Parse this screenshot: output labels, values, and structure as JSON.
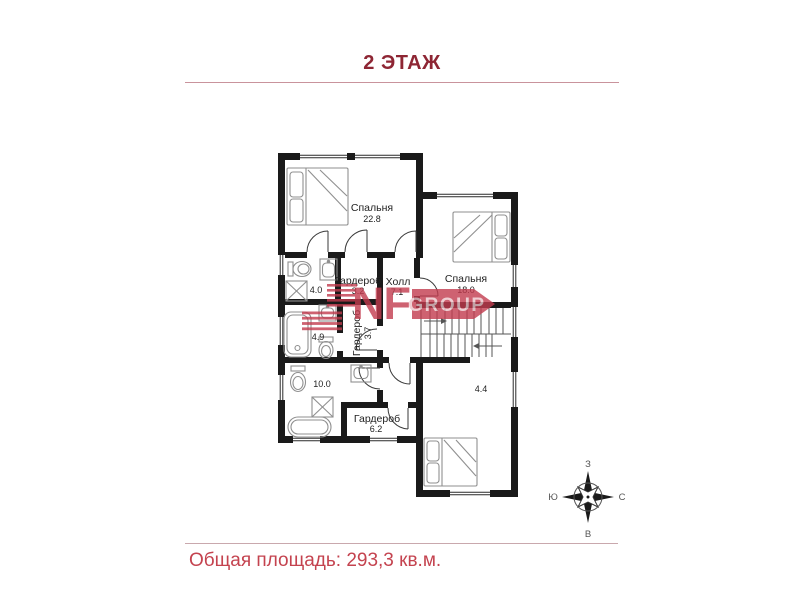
{
  "header": {
    "title": "2 ЭТАЖ"
  },
  "footer": {
    "total_area_label": "Общая площадь: 293,3 кв.м."
  },
  "watermark": {
    "brand_top": "NF",
    "brand_bottom": "GROUP"
  },
  "compass": {
    "top": "З",
    "right": "С",
    "bottom": "В",
    "left": "Ю"
  },
  "plan": {
    "rooms": [
      {
        "name": "Спальня",
        "area": "22.8"
      },
      {
        "name": "Гардероб",
        "area": "3.2"
      },
      {
        "name": "Холл",
        "area": "7.1"
      },
      {
        "name": "Спальня",
        "area": "18.0"
      },
      {
        "name": "",
        "area": "4.0"
      },
      {
        "name": "",
        "area": "4.9"
      },
      {
        "name": "Гардероб",
        "area": "3.7"
      },
      {
        "name": "",
        "area": "10.0"
      },
      {
        "name": "Гардероб",
        "area": "6.2"
      },
      {
        "name": "",
        "area": "4.4"
      }
    ]
  },
  "colors": {
    "title_red": "#8e2634",
    "footer_red": "#c4434f",
    "watermark_red": "#c23b4e",
    "wall_black": "#1a1a1a"
  }
}
